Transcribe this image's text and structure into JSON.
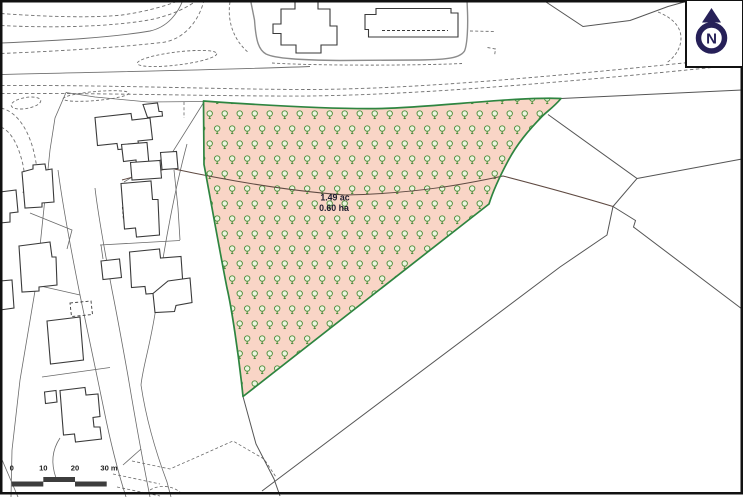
{
  "map": {
    "type": "site-location-plan",
    "site_label": {
      "acres": "1.49 ac",
      "hectares": "0.60 ha"
    },
    "scale_bar": {
      "ticks": [
        "0",
        "10",
        "20",
        "30 m"
      ],
      "bar_color": "#3d3d3d"
    },
    "north": {
      "letter": "N",
      "icon": "north-arrow-icon",
      "color": "#262058"
    },
    "legend_icons": {
      "tree_symbol": "tree-icon"
    },
    "colors": {
      "site_fill": "#f9d5c6",
      "site_border": "#2e8540",
      "tree_green": "#4a8c39",
      "tree_fill": "#edf5e0",
      "building_line": "#3a3a3a",
      "parcel_line": "#6a6a6a",
      "road_dash": "#707070",
      "enclosure_line": "#8c8c8c",
      "field_line": "#555555",
      "old_boundary_arc": "#5f4a42",
      "map_border": "#111111"
    }
  }
}
